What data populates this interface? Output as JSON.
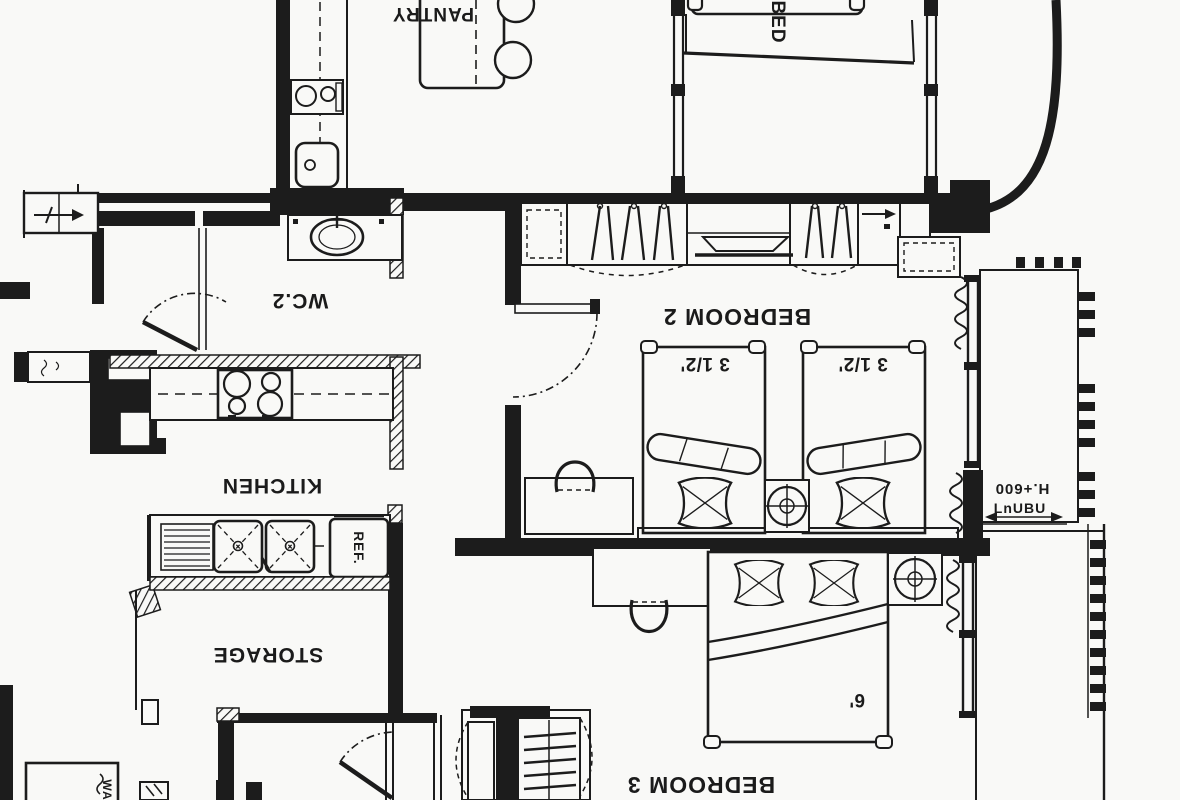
{
  "drawing": {
    "rooms": {
      "pantry": {
        "label": "PANTRY"
      },
      "bedroom1": {
        "label": "BED"
      },
      "wc2": {
        "label": "WC.2"
      },
      "bedroom2": {
        "label": "BEDROOM 2"
      },
      "kitchen": {
        "label": "KITCHEN"
      },
      "storage": {
        "label": "STORAGE"
      },
      "bedroom3": {
        "label": "BEDROOM 3"
      }
    },
    "annotations": {
      "twin_bed_a_size": "3 1/2'",
      "twin_bed_b_size": "3 1/2'",
      "double_bed_size": "6'",
      "refrigerator": "REF.",
      "ledge_height": "H.+600",
      "ledge_note": "LnUBU",
      "washer": "WA"
    },
    "colors": {
      "ink": "#1c1c1c",
      "paper": "#f9f9f7"
    }
  }
}
